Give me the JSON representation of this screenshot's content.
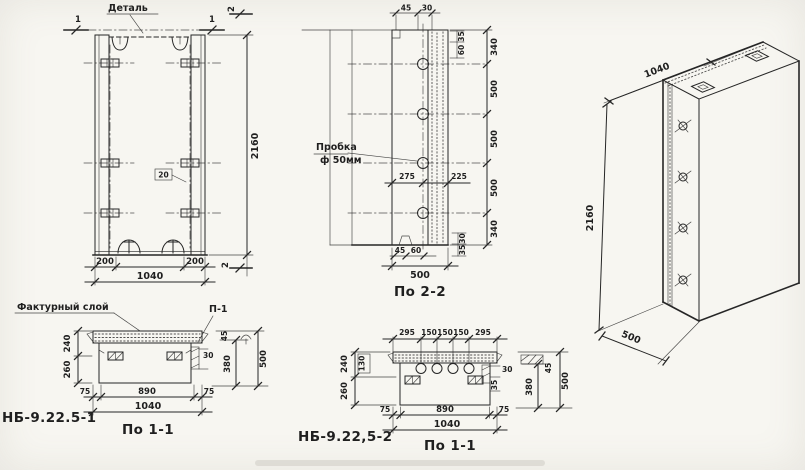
{
  "palette": {
    "paper": "#f7f6f1",
    "ink": "#262626"
  },
  "front": {
    "detail_label": "Деталь",
    "cut_mark_1": "1",
    "cut_mark_2": "2",
    "plate_tag": "20",
    "dim_height": "2160",
    "dim_offset_left": "200",
    "dim_offset_right": "200",
    "dim_width": "1040"
  },
  "section22": {
    "caption": "По 2-2",
    "plug_label": "Пробка",
    "plug_dia": "ф 50мм",
    "dim_top_a": "45",
    "dim_top_b": "30",
    "dim_side_a": "35",
    "dim_side_b": "60",
    "dims_right": [
      "340",
      "500",
      "500",
      "500",
      "340"
    ],
    "dim_mid_left": "275",
    "dim_mid_right": "225",
    "dim_bot_a": "45",
    "dim_bot_b": "60",
    "dim_edge_a": "30",
    "dim_edge_b": "35",
    "dim_depth": "500"
  },
  "iso": {
    "dim_width": "1040",
    "dim_height": "2160",
    "dim_depth": "500"
  },
  "section11a": {
    "part_no": "НБ-9.22.5-1",
    "caption": "По 1-1",
    "facing_label": "Фактурный слой",
    "detail_ref": "П-1",
    "dim_left_top": "240",
    "dim_left_bot": "260",
    "dim_edge": "30",
    "dims_bottom": [
      "75",
      "890",
      "75"
    ],
    "dim_total": "1040",
    "detail_dims": [
      "45",
      "380",
      "500"
    ]
  },
  "section11b": {
    "part_no": "НБ-9.22,5-2",
    "caption": "По 1-1",
    "dims_top": [
      "295",
      "150",
      "150",
      "150",
      "295"
    ],
    "dim_left_top": "240",
    "dim_left_bot": "260",
    "dim_boxed": "130",
    "dim_edge_a": "30",
    "dim_edge_b": "35",
    "dims_bottom": [
      "75",
      "890",
      "75"
    ],
    "dim_total": "1040",
    "detail_dims": [
      "45",
      "380",
      "500"
    ]
  }
}
